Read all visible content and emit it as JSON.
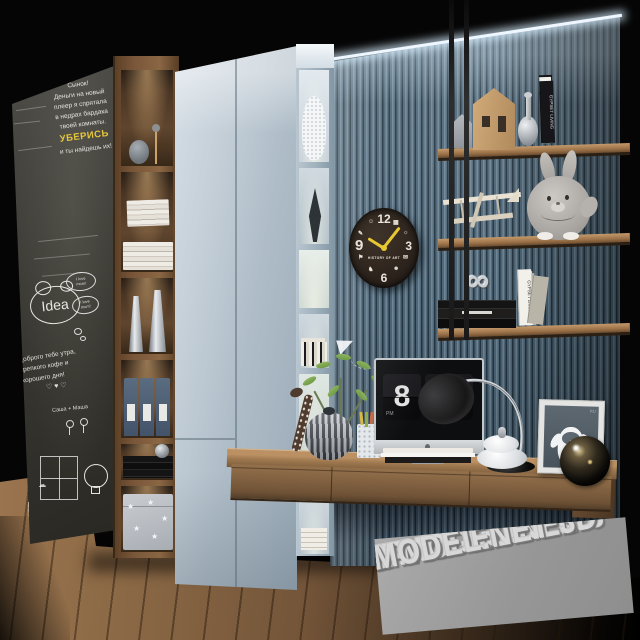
{
  "chalkboard": {
    "note": {
      "l1": "Сынок!",
      "l2": "Деньги на новый",
      "l3": "плеер я спрятала",
      "l4": "в недрах бардака",
      "l5": "твоей комнаты.",
      "l6": "УБЕРИСЬ",
      "l7": "и ты найдешь их!"
    },
    "bubble1a": "I love",
    "bubble1b": "mom!",
    "bubble2a": "I love",
    "bubble2b": "mum!",
    "idea": "Idea",
    "wish": {
      "l1": "Доброго тебе утра,",
      "l2": "крепкого кофе и",
      "l3": "хорошего дня!"
    },
    "names": "Саша + Маша",
    "hearts": "♡ ♥ ♡",
    "clouds": "☁ ☁"
  },
  "clock": {
    "n12": "12",
    "n3": "3",
    "n6": "6",
    "n9": "9",
    "label": "HISTORY OF ART",
    "g1": "▦",
    "g2": "☼",
    "g3": "✉",
    "g4": "☻",
    "g5": "♞",
    "g6": "⚑",
    "g7": "✎",
    "g8": "☺"
  },
  "imac": {
    "hour": "8",
    "minute": "01",
    "meridiem": "PM"
  },
  "wall_shelf_top_books": {
    "b1": "",
    "b2": "",
    "b3": "THE VALENTINO",
    "b4": "Beach Chic",
    "b5": "VOGUE",
    "b6": "AMERICAN FASHION",
    "b7": "GYPSET LIVING"
  },
  "wall_shelf_bottom_books": {
    "b1": "GYPSET LIVING",
    "b2": "",
    "b3": "BALLET",
    "b4": "GYPSET LIVING",
    "b5": ""
  },
  "yeti": {
    "label": "RU"
  },
  "decor": {
    "star": "★",
    "knot": "∞"
  },
  "watermark": {
    "l1": "ET 3D-MODEL",
    "l2": "3D-MODEL.NET 3",
    "l3": "-MODEL.NET 3D"
  },
  "colors": {
    "wardrobe_blue": "#b5c3cf",
    "slat_wall_blue": "#5d7689",
    "wood": "#8a6643",
    "chalkboard": "#3a3933",
    "accent_yellow": "#e7c832",
    "watermark_gray": "#9b9b9b"
  }
}
